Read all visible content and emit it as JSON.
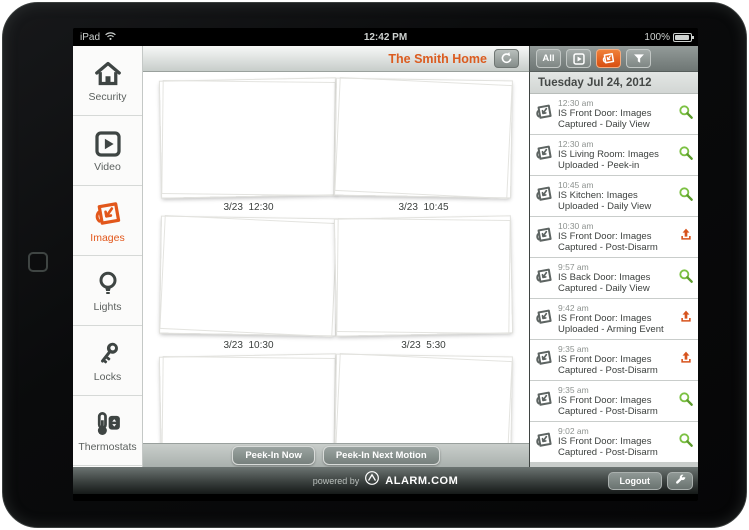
{
  "status_bar": {
    "carrier": "iPad",
    "time": "12:42 PM",
    "battery": "100%"
  },
  "header": {
    "home_name": "The Smith Home"
  },
  "filter_bar": {
    "all_label": "All"
  },
  "sidebar": {
    "items": [
      {
        "label": "Security",
        "selected": false
      },
      {
        "label": "Video",
        "selected": false
      },
      {
        "label": "Images",
        "selected": true
      },
      {
        "label": "Lights",
        "selected": false
      },
      {
        "label": "Locks",
        "selected": false
      },
      {
        "label": "Thermostats",
        "selected": false
      }
    ]
  },
  "gallery": {
    "captions": [
      "3/23  12:30",
      "3/23  10:45",
      "3/23  10:30",
      "3/23  5:30"
    ],
    "peek_now": "Peek-In Now",
    "peek_next": "Peek-In Next Motion"
  },
  "events": {
    "date": "Tuesday Jul 24, 2012",
    "items": [
      {
        "time": "12:30 am",
        "text": "IS Front Door: Images Captured - Daily View",
        "action": "view"
      },
      {
        "time": "12:30 am",
        "text": "IS Living Room: Images Uploaded - Peek-in",
        "action": "view"
      },
      {
        "time": "10:45 am",
        "text": "IS Kitchen: Images Uploaded - Daily View",
        "action": "view"
      },
      {
        "time": "10:30 am",
        "text": "IS Front Door: Images Captured - Post-Disarm",
        "action": "upload"
      },
      {
        "time": "9:57 am",
        "text": "IS Back Door: Images Captured - Daily View",
        "action": "view"
      },
      {
        "time": "9:42 am",
        "text": "IS Front Door: Images Uploaded - Arming Event",
        "action": "upload"
      },
      {
        "time": "9:35 am",
        "text": "IS Front Door: Images Captured - Post-Disarm",
        "action": "upload"
      },
      {
        "time": "9:35 am",
        "text": "IS Front Door: Images Captured - Post-Disarm",
        "action": "view"
      },
      {
        "time": "9:02 am",
        "text": "IS Front Door: Images Captured - Post-Disarm",
        "action": "view"
      }
    ]
  },
  "footer": {
    "powered_by": "powered by",
    "brand": "ALARM.COM",
    "logout_label": "Logout"
  },
  "icons": {
    "wifi": "signal arcs",
    "battery": "filled rect",
    "refresh": "circular arrow",
    "video_filter": "play-square",
    "images_filter": "photo-flip",
    "filter": "funnel",
    "zoom": "green magnifier",
    "upload": "orange up-arrow",
    "event_camera": "gray photo-flip",
    "security": "house",
    "video": "play-square",
    "images": "photo-flip",
    "lights": "bulb",
    "locks": "key",
    "thermostats": "thermometer",
    "logo": "alarm.com circle-peak",
    "settings": "wrench"
  },
  "colors": {
    "accent_orange": "#e2571b",
    "action_green": "#7cc143",
    "action_orange": "#d7531d"
  }
}
